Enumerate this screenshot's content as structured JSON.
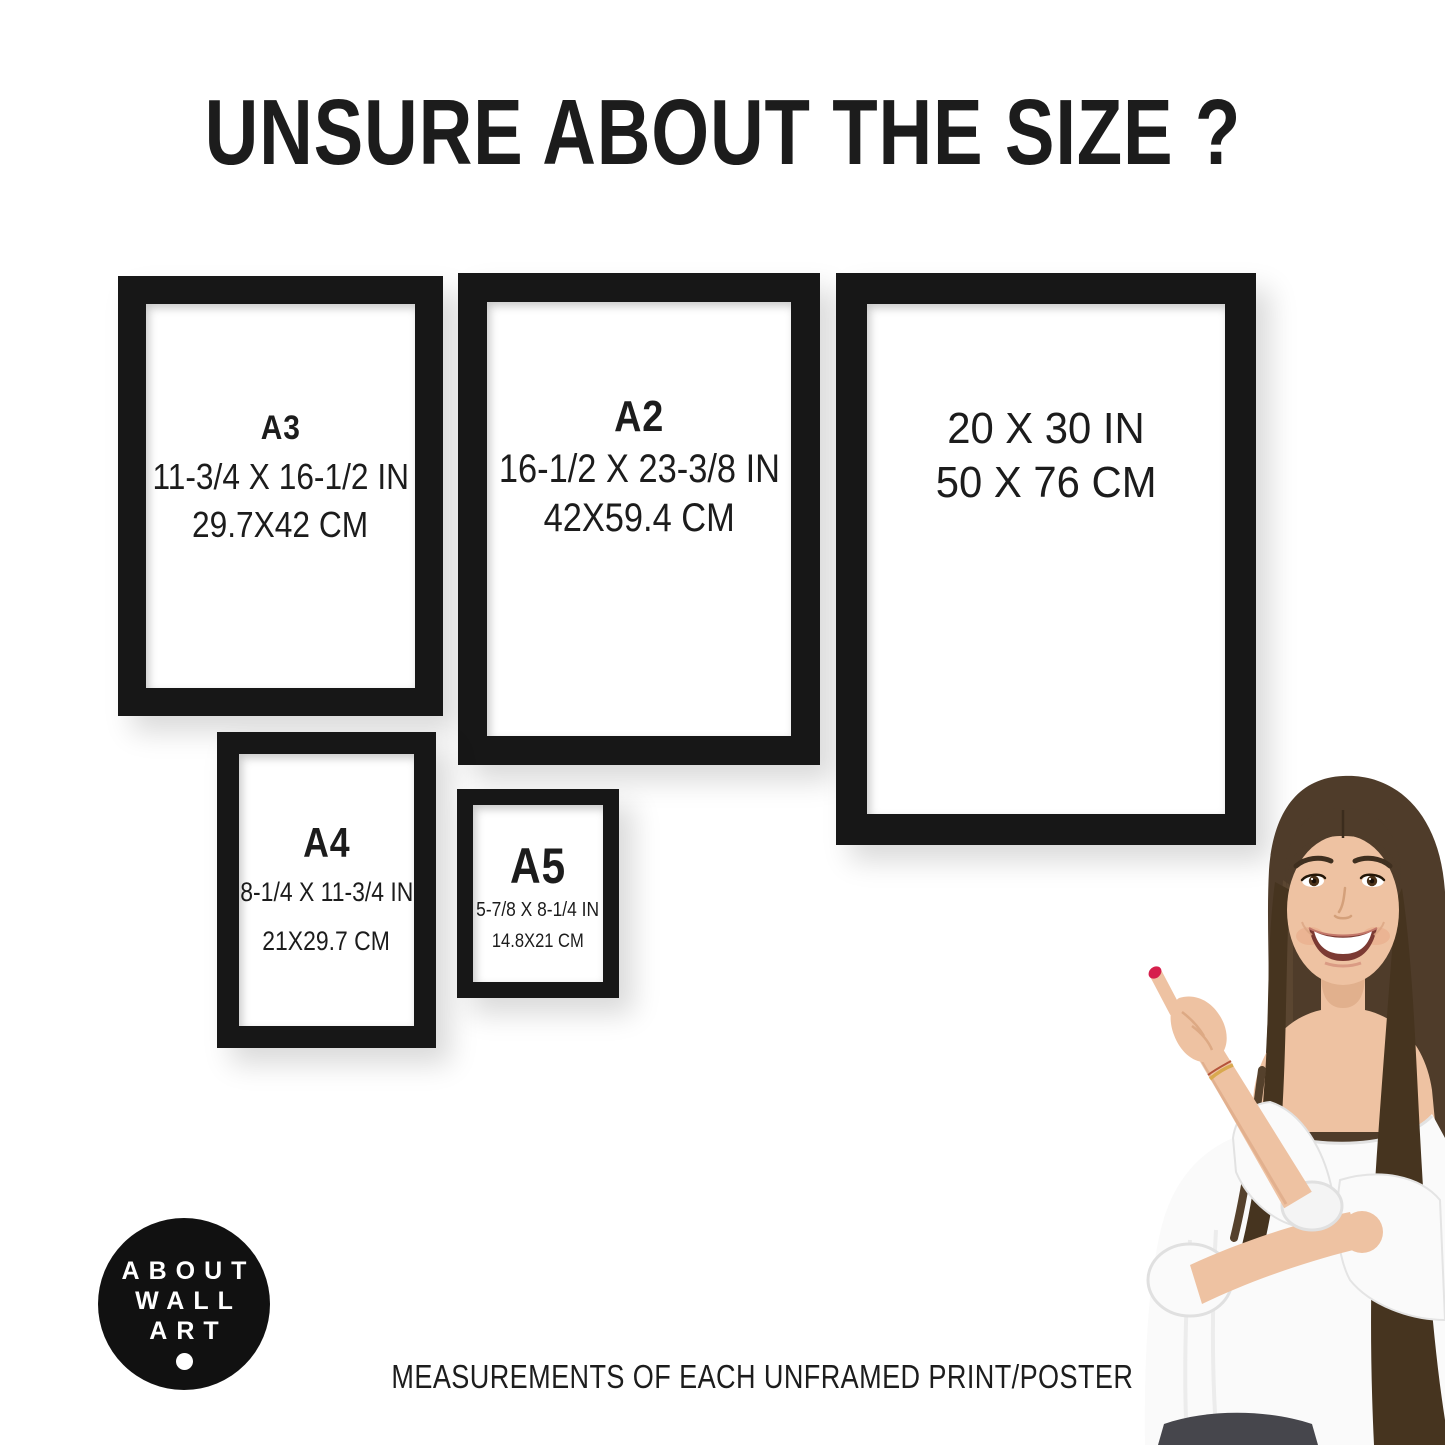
{
  "title": "UNSURE ABOUT THE SIZE ?",
  "caption": "MEASUREMENTS OF EACH UNFRAMED PRINT/POSTER",
  "frames": [
    {
      "label": "A3",
      "inches": "11-3/4 X 16-1/2 IN",
      "cm": "29.7X42 CM"
    },
    {
      "label": "A2",
      "inches": "16-1/2 X 23-3/8 IN",
      "cm": "42X59.4 CM"
    },
    {
      "label": "",
      "inches": "20 X 30 IN",
      "cm": "50 X 76 CM"
    },
    {
      "label": "A4",
      "inches": "8-1/4 X 11-3/4 IN",
      "cm": "21X29.7 CM"
    },
    {
      "label": "A5",
      "inches": "5-7/8 X 8-1/4 IN",
      "cm": "14.8X21 CM"
    }
  ],
  "logo": {
    "line1": "ABOUT",
    "line2": "WALL",
    "line3": "ART"
  },
  "colors": {
    "frame": "#171717",
    "text": "#1c1c1c",
    "logo_bg": "#111111",
    "logo_text": "#ffffff",
    "hair": "#4f3c2a",
    "hair_dark": "#46341f",
    "hair_light": "#6b533a",
    "skin": "#eec2a2",
    "skin_shadow": "#d9a47e",
    "blouse": "#fafafa",
    "blouse_edge": "#e2e2e2",
    "nail": "#d61f4c",
    "jeans": "#46464c",
    "mouth": "#7c3a33",
    "teeth": "#ffffff",
    "bracelet": "#d9a94e"
  }
}
